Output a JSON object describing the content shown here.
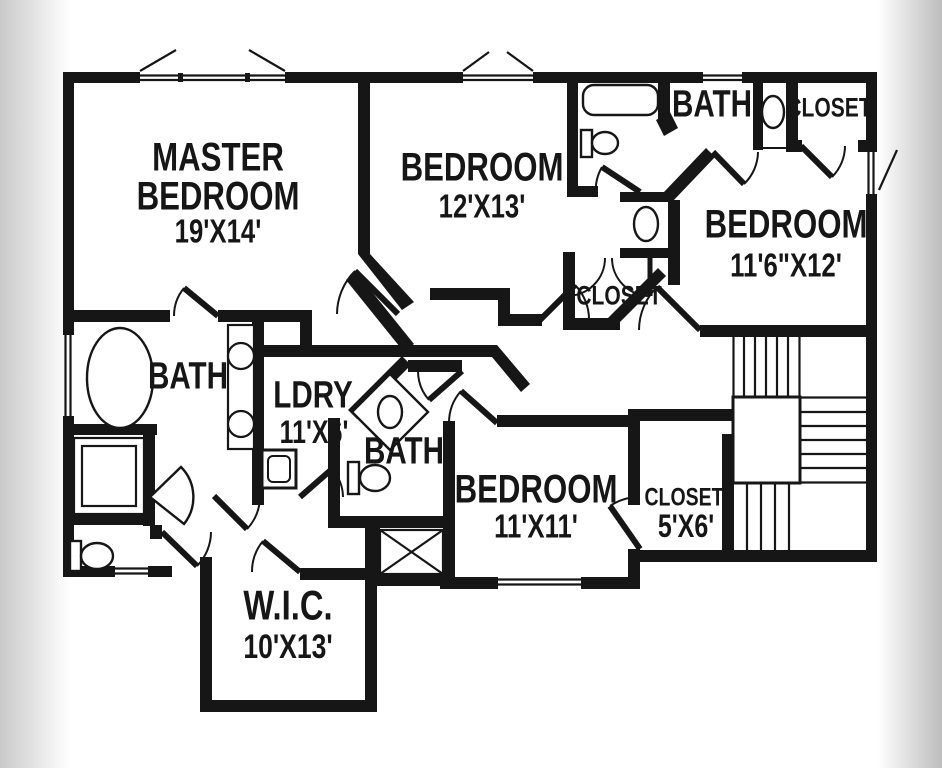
{
  "image_type": "second-floor residential floor plan, black and white line drawing",
  "colors": {
    "walls": "#161616",
    "background": "#ffffff",
    "edge_shadow_left": "#c9c9c9",
    "edge_shadow_right": "#bfbfbf"
  },
  "rooms": {
    "master": {
      "line1": "MASTER",
      "line2": "BEDROOM",
      "dims": "19'X14'"
    },
    "bedroom2": {
      "line1": "BEDROOM",
      "dims": "12'X13'"
    },
    "bath_top": {
      "label": "BATH"
    },
    "closet_top": {
      "label": "CLOSET"
    },
    "bedroom3": {
      "line1": "BEDROOM",
      "dims": "11'6\"X12'"
    },
    "closet_mid": {
      "label": "CLOSET"
    },
    "bath_master": {
      "label": "BATH"
    },
    "laundry": {
      "label": "LDRY",
      "dims": "11'X6'"
    },
    "bath_mid": {
      "label": "BATH"
    },
    "bedroom4": {
      "line1": "BEDROOM",
      "dims": "11'X11'"
    },
    "closet4": {
      "label": "CLOSET",
      "dims": "5'X6'"
    },
    "wic": {
      "label": "W.I.C.",
      "dims": "10'X13'"
    }
  },
  "fixtures": [
    "bathtub-icon",
    "toilet-icon",
    "sink-icon",
    "closet-rod-icon",
    "garden-tub-icon",
    "double-vanity-icon",
    "shower-icon",
    "utility-sink-icon",
    "corner-sink-icon",
    "linen-closet-icon",
    "staircase-icon",
    "window-icon",
    "door-swing-icon"
  ]
}
